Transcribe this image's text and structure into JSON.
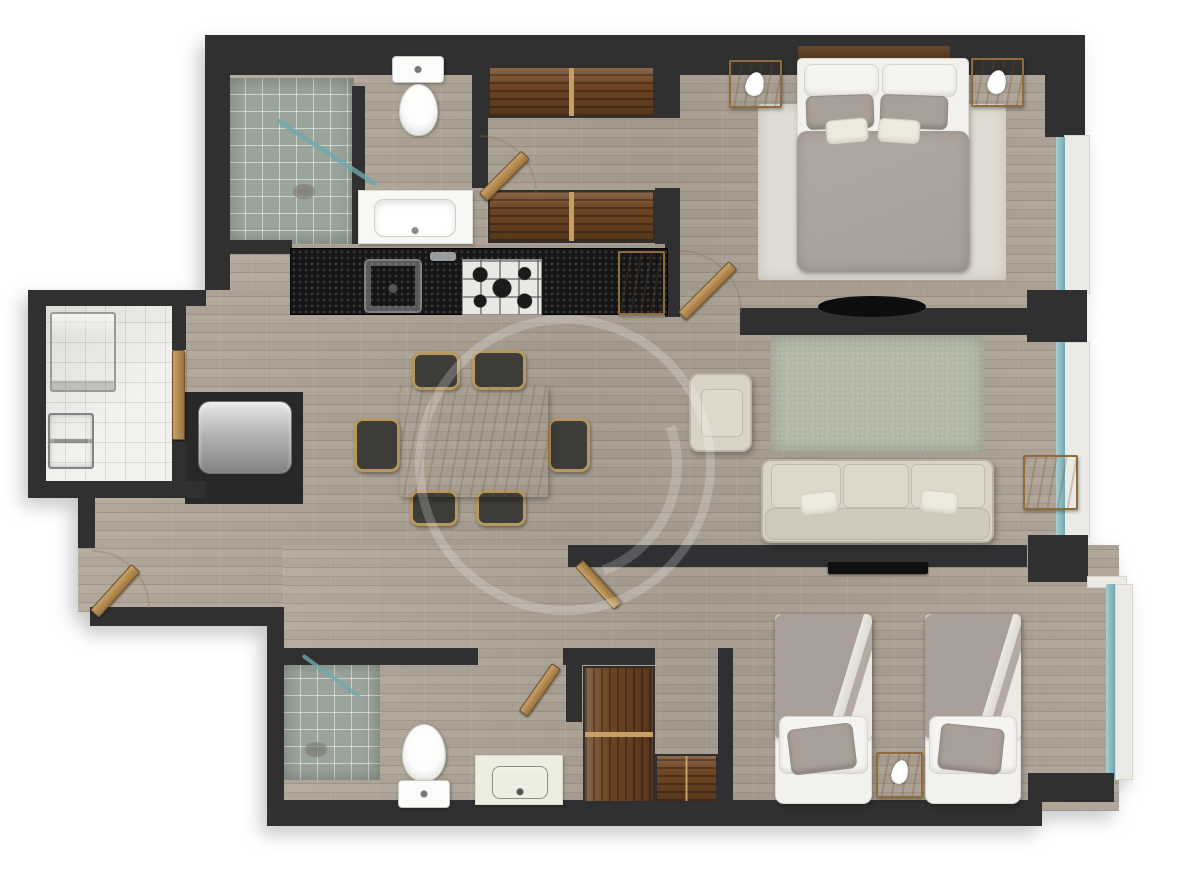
{
  "meta": {
    "title": "two-bedroom-apartment-floor-plan",
    "canvas": {
      "width": 1200,
      "height": 883
    }
  },
  "palette": {
    "wall": "#303030",
    "floor": "#b2a89b",
    "tile": "#f2f1ed",
    "shower": "#9aa49a",
    "counter": "#161616",
    "darkwood": "#6e4523",
    "tan": "#c99e63",
    "beige": "#d9d3c5",
    "sage": "#b3b8a6",
    "duvet": "#a89f98",
    "white": "#f2f1ee",
    "glass": "#6fa7ae",
    "sill": "#eceae4",
    "rug": "#e0dcd3",
    "arc": "rgba(140,115,80,0.55)"
  },
  "plan": {
    "rooms": [
      "main-bathroom",
      "walk-in-closet",
      "master-bedroom",
      "kitchen",
      "laundry-room",
      "dining-area",
      "living-room",
      "hallway",
      "second-bathroom",
      "second-bedroom"
    ],
    "items": [
      {
        "n": "floor-upper-wing",
        "k": "wf",
        "x": 205,
        "y": 40,
        "w": 880,
        "h": 296
      },
      {
        "n": "floor-central",
        "k": "wf",
        "x": 78,
        "y": 290,
        "w": 1000,
        "h": 322
      },
      {
        "n": "floor-lower-wing",
        "k": "wf",
        "x": 283,
        "y": 545,
        "w": 836,
        "h": 266
      },
      {
        "n": "laundry-tile-floor",
        "k": "tile",
        "x": 45,
        "y": 303,
        "w": 141,
        "h": 192
      },
      {
        "n": "shower-floor-main-bath",
        "k": "shower",
        "x": 228,
        "y": 78,
        "w": 126,
        "h": 166
      },
      {
        "n": "shower-floor-second-bath",
        "k": "shower",
        "x": 283,
        "y": 662,
        "w": 97,
        "h": 118
      },
      {
        "n": "master-bedroom-rug",
        "k": "rug",
        "x": 758,
        "y": 104,
        "w": 248,
        "h": 176
      },
      {
        "n": "living-room-rug",
        "k": "rugg",
        "x": 770,
        "y": 336,
        "w": 214,
        "h": 116
      },
      {
        "n": "washing-machine",
        "k": "washer",
        "x": 50,
        "y": 312,
        "w": 66,
        "h": 80
      },
      {
        "n": "laundry-sink",
        "k": "lsink",
        "x": 48,
        "y": 413,
        "w": 46,
        "h": 56
      },
      {
        "n": "water-heater-niche",
        "k": "alcove",
        "x": 185,
        "y": 392,
        "w": 118,
        "h": 112
      },
      {
        "n": "water-heater",
        "k": "heater",
        "x": 198,
        "y": 401,
        "w": 94,
        "h": 73
      },
      {
        "n": "wall-top",
        "k": "owall",
        "x": 205,
        "y": 35,
        "w": 880,
        "h": 40
      },
      {
        "n": "wall-upper-left",
        "k": "owall",
        "x": 205,
        "y": 35,
        "w": 25,
        "h": 255
      },
      {
        "n": "wall-top-right-corner",
        "k": "owall",
        "x": 1045,
        "y": 35,
        "w": 40,
        "h": 102
      },
      {
        "n": "window-sill-master",
        "k": "sill",
        "x": 1064,
        "y": 135,
        "w": 26,
        "h": 159
      },
      {
        "n": "window-glass-master",
        "k": "glass",
        "x": 1056,
        "y": 137,
        "w": 9,
        "h": 155
      },
      {
        "n": "wall-pillar-mid-right",
        "k": "owall",
        "x": 1027,
        "y": 290,
        "w": 60,
        "h": 52
      },
      {
        "n": "window-sill-living",
        "k": "sill",
        "x": 1064,
        "y": 342,
        "w": 26,
        "h": 195
      },
      {
        "n": "window-glass-living",
        "k": "glass",
        "x": 1056,
        "y": 342,
        "w": 9,
        "h": 193
      },
      {
        "n": "wall-pillar-living-bedroom2",
        "k": "owall",
        "x": 1028,
        "y": 535,
        "w": 60,
        "h": 47
      },
      {
        "n": "window-sill-bedroom2-top",
        "k": "sill",
        "x": 1087,
        "y": 576,
        "w": 40,
        "h": 12
      },
      {
        "n": "window-glass-bedroom2",
        "k": "glass",
        "x": 1106,
        "y": 584,
        "w": 9,
        "h": 196
      },
      {
        "n": "window-sill-bedroom2",
        "k": "sill",
        "x": 1115,
        "y": 584,
        "w": 18,
        "h": 196
      },
      {
        "n": "wall-bottom-right-step",
        "k": "owall",
        "x": 1028,
        "y": 773,
        "w": 86,
        "h": 29
      },
      {
        "n": "wall-bottom",
        "k": "owall",
        "x": 270,
        "y": 800,
        "w": 772,
        "h": 26
      },
      {
        "n": "wall-left-step-vertical",
        "k": "owall",
        "x": 267,
        "y": 607,
        "w": 17,
        "h": 219
      },
      {
        "n": "wall-left-step-horizontal",
        "k": "owall",
        "x": 90,
        "y": 607,
        "w": 194,
        "h": 19
      },
      {
        "n": "wall-entry-stub",
        "k": "owall",
        "x": 78,
        "y": 495,
        "w": 17,
        "h": 53
      },
      {
        "n": "wall-laundry-left",
        "k": "owall",
        "x": 28,
        "y": 290,
        "w": 18,
        "h": 207
      },
      {
        "n": "wall-laundry-top",
        "k": "owall",
        "x": 28,
        "y": 290,
        "w": 178,
        "h": 16
      },
      {
        "n": "wall-laundry-bottom",
        "k": "owall",
        "x": 28,
        "y": 481,
        "w": 178,
        "h": 17
      },
      {
        "n": "wall-laundry-door-upper",
        "k": "wall",
        "x": 172,
        "y": 306,
        "w": 14,
        "h": 44
      },
      {
        "n": "wall-laundry-door-lower",
        "k": "wall",
        "x": 172,
        "y": 438,
        "w": 14,
        "h": 45
      },
      {
        "n": "wall-shower-partition",
        "k": "wall",
        "x": 352,
        "y": 86,
        "w": 13,
        "h": 158
      },
      {
        "n": "wall-bath-closet",
        "k": "wall",
        "x": 472,
        "y": 56,
        "w": 16,
        "h": 132
      },
      {
        "n": "wall-closet-top-end",
        "k": "wall",
        "x": 655,
        "y": 64,
        "w": 25,
        "h": 54
      },
      {
        "n": "wall-closet-bottom-end",
        "k": "wall",
        "x": 655,
        "y": 188,
        "w": 25,
        "h": 56
      },
      {
        "n": "wall-master-entry",
        "k": "wall",
        "x": 665,
        "y": 242,
        "w": 15,
        "h": 70
      },
      {
        "n": "wall-under-vanity",
        "k": "wall",
        "x": 228,
        "y": 240,
        "w": 64,
        "h": 14
      },
      {
        "n": "wall-kitchen-end",
        "k": "wall",
        "x": 665,
        "y": 246,
        "w": 15,
        "h": 71
      },
      {
        "n": "kitchen-counter",
        "k": "counter",
        "x": 290,
        "y": 248,
        "w": 378,
        "h": 67
      },
      {
        "n": "kitchen-sink",
        "k": "sink",
        "x": 364,
        "y": 259,
        "w": 58,
        "h": 54
      },
      {
        "n": "kitchen-faucet",
        "k": "fct",
        "x": 430,
        "y": 252,
        "w": 26,
        "h": 9
      },
      {
        "n": "kitchen-stove",
        "k": "stove",
        "x": 462,
        "y": 259,
        "w": 80,
        "h": 56
      },
      {
        "n": "kitchen-cabinet",
        "k": "wood",
        "x": 618,
        "y": 251,
        "w": 47,
        "h": 64
      },
      {
        "n": "toilet-tank-main-bath",
        "k": "ttank",
        "x": 392,
        "y": 56,
        "w": 52,
        "h": 27
      },
      {
        "n": "toilet-bowl-main-bath",
        "k": "tbowl",
        "x": 399,
        "y": 84,
        "w": 39,
        "h": 52
      },
      {
        "n": "vanity-main-bath",
        "k": "vanity",
        "x": 358,
        "y": 190,
        "w": 115,
        "h": 54
      },
      {
        "n": "vanity-basin-main-bath",
        "k": "basin",
        "x": 374,
        "y": 199,
        "w": 82,
        "h": 38
      },
      {
        "n": "shower-glass-main-bath",
        "k": "gl",
        "x": 268,
        "y": 150,
        "w": 118,
        "h": 5,
        "r": 33
      },
      {
        "n": "shower-drain-main-bath",
        "k": "drain",
        "x": 293,
        "y": 184,
        "w": 22,
        "h": 15
      },
      {
        "n": "master-closet-top",
        "k": "wardh",
        "x": 488,
        "y": 66,
        "w": 167,
        "h": 52
      },
      {
        "n": "master-closet-bottom",
        "k": "wardh",
        "x": 488,
        "y": 190,
        "w": 167,
        "h": 53
      },
      {
        "n": "tv-wall-master",
        "k": "wall",
        "x": 740,
        "y": 308,
        "w": 287,
        "h": 27
      },
      {
        "n": "tv-master-bedroom",
        "k": "tvell",
        "x": 818,
        "y": 296,
        "w": 108,
        "h": 21
      },
      {
        "n": "tv-wall-bedroom2",
        "k": "wall",
        "x": 568,
        "y": 545,
        "w": 459,
        "h": 22
      },
      {
        "n": "tv-bedroom2",
        "k": "tv",
        "x": 828,
        "y": 562,
        "w": 100,
        "h": 12
      },
      {
        "n": "master-headboard",
        "k": "hb",
        "x": 798,
        "y": 46,
        "w": 152,
        "h": 17
      },
      {
        "n": "master-bed-base",
        "k": "bb",
        "x": 797,
        "y": 58,
        "w": 172,
        "h": 212
      },
      {
        "n": "master-pillow-left",
        "k": "pw",
        "x": 804,
        "y": 64,
        "w": 75,
        "h": 33
      },
      {
        "n": "master-pillow-right",
        "k": "pw",
        "x": 882,
        "y": 64,
        "w": 75,
        "h": 33
      },
      {
        "n": "master-pillow-gray-left",
        "k": "pg",
        "x": 806,
        "y": 95,
        "w": 68,
        "h": 34,
        "r": -2
      },
      {
        "n": "master-pillow-gray-right",
        "k": "pg",
        "x": 880,
        "y": 95,
        "w": 68,
        "h": 34,
        "r": 2
      },
      {
        "n": "master-duvet",
        "k": "duvet",
        "x": 797,
        "y": 131,
        "w": 172,
        "h": 140
      },
      {
        "n": "master-cushion-left",
        "k": "cu",
        "x": 826,
        "y": 119,
        "w": 42,
        "h": 24,
        "r": -5
      },
      {
        "n": "master-cushion-right",
        "k": "cu",
        "x": 878,
        "y": 119,
        "w": 42,
        "h": 24,
        "r": 4
      },
      {
        "n": "nightstand-left",
        "k": "wood",
        "x": 729,
        "y": 60,
        "w": 53,
        "h": 48
      },
      {
        "n": "lamp-left",
        "k": "lamp",
        "x": 746,
        "y": 72,
        "w": 18,
        "h": 24
      },
      {
        "n": "nightstand-right",
        "k": "wood",
        "x": 971,
        "y": 58,
        "w": 53,
        "h": 49
      },
      {
        "n": "lamp-right",
        "k": "lamp",
        "x": 988,
        "y": 70,
        "w": 18,
        "h": 24
      },
      {
        "n": "armchair",
        "k": "sofa",
        "x": 689,
        "y": 373,
        "w": 63,
        "h": 79
      },
      {
        "n": "armchair-cushion",
        "k": "scu",
        "x": 701,
        "y": 389,
        "w": 42,
        "h": 48
      },
      {
        "n": "sofa",
        "k": "sofa",
        "x": 761,
        "y": 459,
        "w": 233,
        "h": 84
      },
      {
        "n": "sofa-cushion-1",
        "k": "scu",
        "x": 771,
        "y": 464,
        "w": 70,
        "h": 44
      },
      {
        "n": "sofa-cushion-2",
        "k": "scu",
        "x": 843,
        "y": 464,
        "w": 66,
        "h": 44
      },
      {
        "n": "sofa-cushion-3",
        "k": "scu",
        "x": 911,
        "y": 464,
        "w": 74,
        "h": 44
      },
      {
        "n": "sofa-back",
        "k": "sback",
        "x": 765,
        "y": 508,
        "w": 225,
        "h": 32
      },
      {
        "n": "sofa-pillow-left",
        "k": "cu",
        "x": 800,
        "y": 492,
        "w": 38,
        "h": 22,
        "r": -7
      },
      {
        "n": "sofa-pillow-right",
        "k": "cu",
        "x": 920,
        "y": 491,
        "w": 38,
        "h": 22,
        "r": 6
      },
      {
        "n": "side-table",
        "k": "wood",
        "x": 1023,
        "y": 455,
        "w": 55,
        "h": 55
      },
      {
        "n": "dining-chair-top-1",
        "k": "chair",
        "x": 412,
        "y": 352,
        "w": 48,
        "h": 38
      },
      {
        "n": "dining-chair-top-2",
        "k": "chair",
        "x": 472,
        "y": 350,
        "w": 54,
        "h": 40
      },
      {
        "n": "dining-chair-bottom-1",
        "k": "chair",
        "x": 410,
        "y": 490,
        "w": 48,
        "h": 36
      },
      {
        "n": "dining-chair-bottom-2",
        "k": "chair",
        "x": 476,
        "y": 490,
        "w": 50,
        "h": 36
      },
      {
        "n": "dining-chair-left",
        "k": "chair",
        "x": 354,
        "y": 418,
        "w": 46,
        "h": 54
      },
      {
        "n": "dining-chair-right",
        "k": "chair",
        "x": 548,
        "y": 418,
        "w": 42,
        "h": 54
      },
      {
        "n": "dining-table",
        "k": "table",
        "x": 400,
        "y": 385,
        "w": 148,
        "h": 112
      },
      {
        "n": "wall-bath2-top-left",
        "k": "wall",
        "x": 270,
        "y": 648,
        "w": 208,
        "h": 17
      },
      {
        "n": "wall-bath2-top-right",
        "k": "wall",
        "x": 563,
        "y": 648,
        "w": 92,
        "h": 17
      },
      {
        "n": "wall-bath2-right",
        "k": "wall",
        "x": 566,
        "y": 648,
        "w": 16,
        "h": 74
      },
      {
        "n": "wall-bedroom2-closet",
        "k": "wall",
        "x": 718,
        "y": 648,
        "w": 15,
        "h": 172
      },
      {
        "n": "toilet-bowl-second-bath",
        "k": "tbowl",
        "x": 402,
        "y": 724,
        "w": 44,
        "h": 58
      },
      {
        "n": "toilet-tank-second-bath",
        "k": "ttank",
        "x": 398,
        "y": 780,
        "w": 52,
        "h": 28
      },
      {
        "n": "vanity-second-bath",
        "k": "vanity2",
        "x": 475,
        "y": 755,
        "w": 88,
        "h": 50
      },
      {
        "n": "vanity-basin-second-bath",
        "k": "basin2",
        "x": 492,
        "y": 766,
        "w": 56,
        "h": 33
      },
      {
        "n": "shower-glass-second-bath",
        "k": "gl",
        "x": 296,
        "y": 674,
        "w": 70,
        "h": 4,
        "r": 36
      },
      {
        "n": "shower-drain-second-bath",
        "k": "drain",
        "x": 305,
        "y": 742,
        "w": 22,
        "h": 15
      },
      {
        "n": "bedroom2-closet-vertical",
        "k": "wardv",
        "x": 583,
        "y": 666,
        "w": 72,
        "h": 137
      },
      {
        "n": "bedroom2-closet-horizontal",
        "k": "wardh",
        "x": 655,
        "y": 754,
        "w": 63,
        "h": 49
      },
      {
        "n": "bed2-left-base",
        "k": "bb",
        "x": 775,
        "y": 614,
        "w": 97,
        "h": 190
      },
      {
        "n": "bed2-left-duvet",
        "k": "duvet2",
        "x": 775,
        "y": 614,
        "w": 97,
        "h": 124
      },
      {
        "n": "bed2-left-pillow",
        "k": "pw",
        "x": 779,
        "y": 716,
        "w": 89,
        "h": 58
      },
      {
        "n": "bed2-left-pillow-gray",
        "k": "pg",
        "x": 789,
        "y": 726,
        "w": 66,
        "h": 46,
        "r": -7
      },
      {
        "n": "bed2-right-base",
        "k": "bb",
        "x": 925,
        "y": 614,
        "w": 96,
        "h": 190
      },
      {
        "n": "bed2-right-duvet",
        "k": "duvet2",
        "x": 925,
        "y": 614,
        "w": 96,
        "h": 124
      },
      {
        "n": "bed2-right-pillow",
        "k": "pw",
        "x": 929,
        "y": 716,
        "w": 88,
        "h": 58
      },
      {
        "n": "bed2-right-pillow-gray",
        "k": "pg",
        "x": 939,
        "y": 726,
        "w": 64,
        "h": 46,
        "r": 6
      },
      {
        "n": "nightstand-bedroom2",
        "k": "wood",
        "x": 876,
        "y": 752,
        "w": 47,
        "h": 46
      },
      {
        "n": "lamp-bedroom2",
        "k": "lamp",
        "x": 892,
        "y": 760,
        "w": 16,
        "h": 24
      },
      {
        "n": "entry-door-swing",
        "k": "swing",
        "x": 92,
        "y": 550,
        "w": 58,
        "h": 58
      },
      {
        "n": "entry-door",
        "k": "door",
        "x": 90,
        "y": 548,
        "w": 12,
        "h": 62,
        "r": 42,
        "o": "bl"
      },
      {
        "n": "laundry-door",
        "k": "door",
        "x": 172,
        "y": 350,
        "w": 13,
        "h": 90
      },
      {
        "n": "main-bath-door-swing",
        "k": "swing",
        "x": 479,
        "y": 135,
        "w": 58,
        "h": 58
      },
      {
        "n": "main-bath-door",
        "k": "door",
        "x": 479,
        "y": 133,
        "w": 12,
        "h": 60,
        "r": 45,
        "o": "bl"
      },
      {
        "n": "master-bedroom-door-swing",
        "k": "swing",
        "x": 680,
        "y": 250,
        "w": 62,
        "h": 62
      },
      {
        "n": "master-bedroom-door",
        "k": "door",
        "x": 678,
        "y": 240,
        "w": 12,
        "h": 72,
        "r": 45,
        "o": "bl"
      },
      {
        "n": "bedroom2-door",
        "k": "door",
        "x": 575,
        "y": 567,
        "w": 11,
        "h": 58,
        "r": -42,
        "o": "tl"
      },
      {
        "n": "second-bath-door",
        "k": "door",
        "x": 552,
        "y": 663,
        "w": 11,
        "h": 58,
        "r": 35,
        "o": "tl"
      },
      {
        "n": "watermark-ring",
        "k": "wm",
        "x": 415,
        "y": 315,
        "w": 300,
        "h": 300
      },
      {
        "n": "watermark-arc",
        "k": "wmarc",
        "x": 448,
        "y": 348,
        "w": 234,
        "h": 234
      }
    ]
  }
}
